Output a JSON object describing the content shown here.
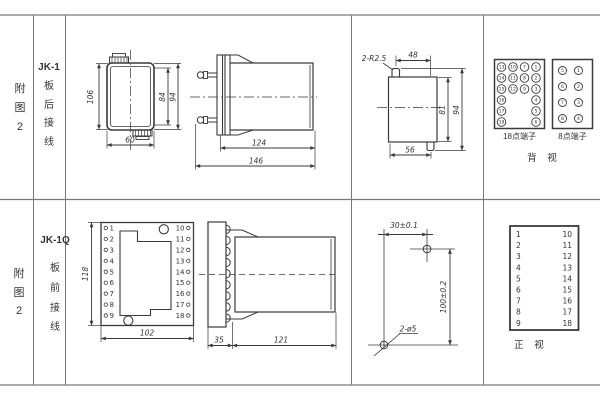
{
  "page": {
    "background": "#ffffff",
    "line_color": "#3a3a3a",
    "grid_color": "#7a7a7a"
  },
  "row1": {
    "figure_label": [
      "附",
      "图",
      "2"
    ],
    "model": "JK-1",
    "wiring_label": [
      "板",
      "后",
      "接",
      "线"
    ],
    "dims": {
      "height_outer": "106",
      "height_inner": "84",
      "height_full": "94",
      "width": "60",
      "body_len": "124",
      "total_len": "146"
    },
    "cutout": {
      "radius_note": "2-R2.5",
      "top_width": "48",
      "inner_height": "81",
      "full_height": "94",
      "bottom_width": "56"
    },
    "terminal18": {
      "label": "18点端子",
      "col1": [
        13,
        14,
        15,
        16,
        17,
        18
      ],
      "col2": [
        10,
        11,
        12
      ],
      "col3": [
        7,
        8,
        9
      ],
      "col4": [
        1,
        2,
        3,
        4,
        5,
        6
      ]
    },
    "terminal8": {
      "label": "8点端子",
      "left": [
        5,
        6,
        7,
        8
      ],
      "right": [
        1,
        2,
        3,
        4
      ]
    },
    "view_label": "背 视"
  },
  "row2": {
    "figure_label": [
      "附",
      "图",
      "2"
    ],
    "model": "JK-1Q",
    "wiring_label": [
      "板",
      "前",
      "接",
      "线"
    ],
    "dims": {
      "height": "118",
      "width": "102",
      "plate": "35",
      "body": "121",
      "hole_h": "30±0.1",
      "hole_v": "100±0.2",
      "holes": "2-ø5"
    },
    "front_left": [
      1,
      2,
      3,
      4,
      5,
      6,
      7,
      8,
      9
    ],
    "front_right": [
      10,
      11,
      12,
      13,
      14,
      15,
      16,
      17,
      18
    ],
    "table_left": [
      1,
      2,
      3,
      4,
      5,
      6,
      7,
      8,
      9
    ],
    "table_right": [
      10,
      11,
      12,
      13,
      14,
      15,
      16,
      17,
      18
    ],
    "view_label": "正 视"
  }
}
